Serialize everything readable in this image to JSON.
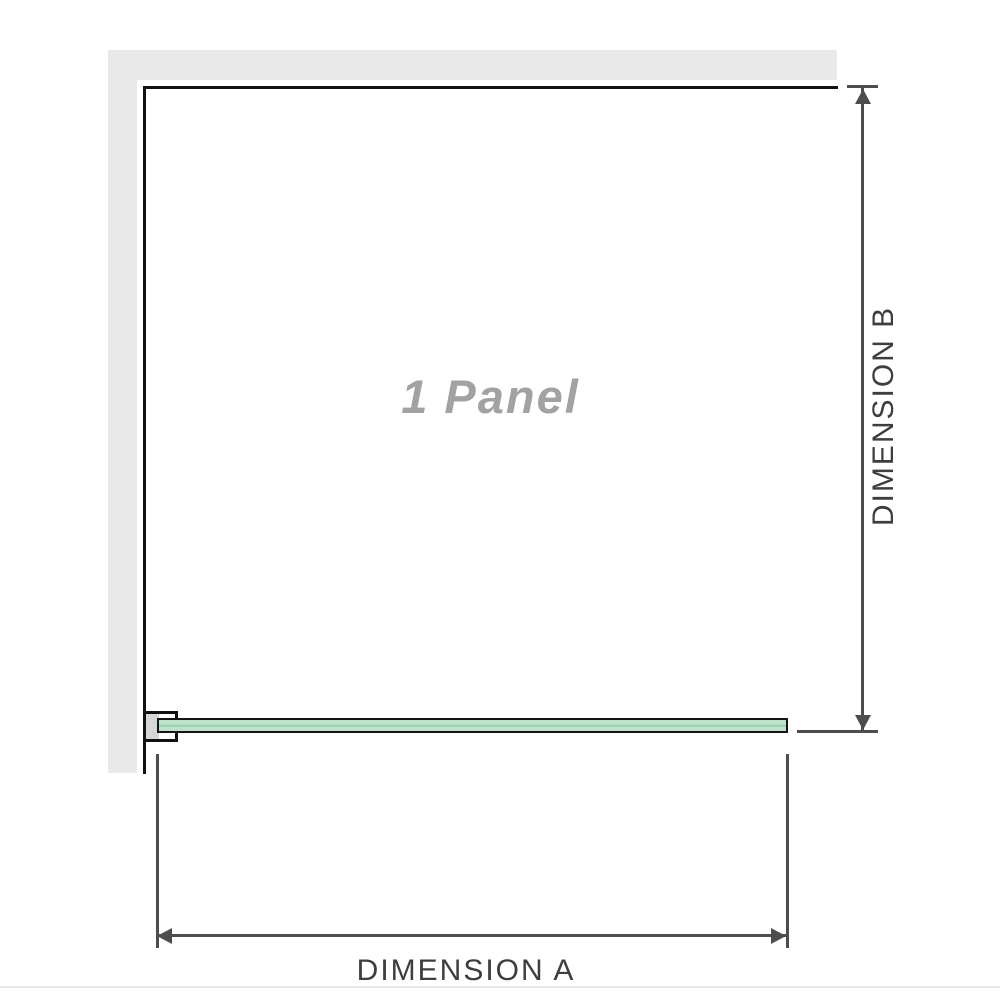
{
  "diagram": {
    "panel_label": "1 Panel",
    "dimensions": {
      "a_label": "DIMENSION A",
      "b_label": "DIMENSION B"
    }
  },
  "colors": {
    "wall": "#e9e9e9",
    "frame_line": "#111111",
    "dim_line": "#4d4d4d",
    "dim_text": "#3e3e3e",
    "panel_text": "#a2a2a2",
    "glass_fill": "#bee2cb",
    "glass_mid": "#98cfad",
    "glass_border": "#141414",
    "bracket_fill": "#d6d6d6",
    "divider": "#e9e8e3"
  }
}
